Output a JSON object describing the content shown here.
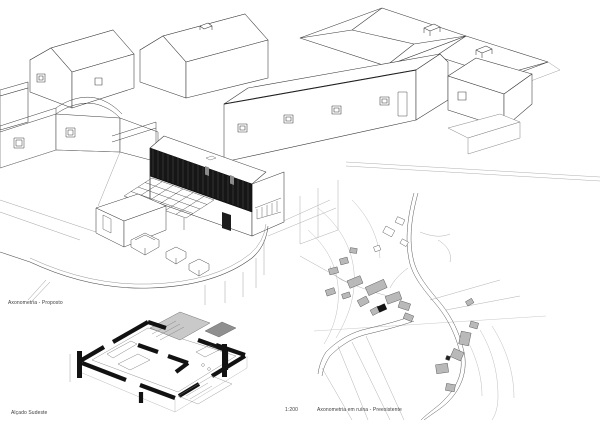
{
  "sheet": {
    "background": "#ffffff",
    "width_px": 600,
    "height_px": 425
  },
  "palette": {
    "drawing_line": "#333333",
    "faint_line": "#999999",
    "highlight_facade_fill": "#161616",
    "cut_wall_fill": "#121212",
    "slab_gray": "#c9c9c9",
    "site_building_fill": "#b9b9b9",
    "site_subject_fill": "#151515",
    "label_color": "#3d3d3d"
  },
  "drawings": {
    "axon_proposed": {
      "label": "Axonometria - Proposto"
    },
    "section_axon": {
      "label": "Alçado Sudeste"
    },
    "site_plan": {
      "scale": "1:200",
      "label": "Axonometria em ruína - Preexistente"
    }
  }
}
